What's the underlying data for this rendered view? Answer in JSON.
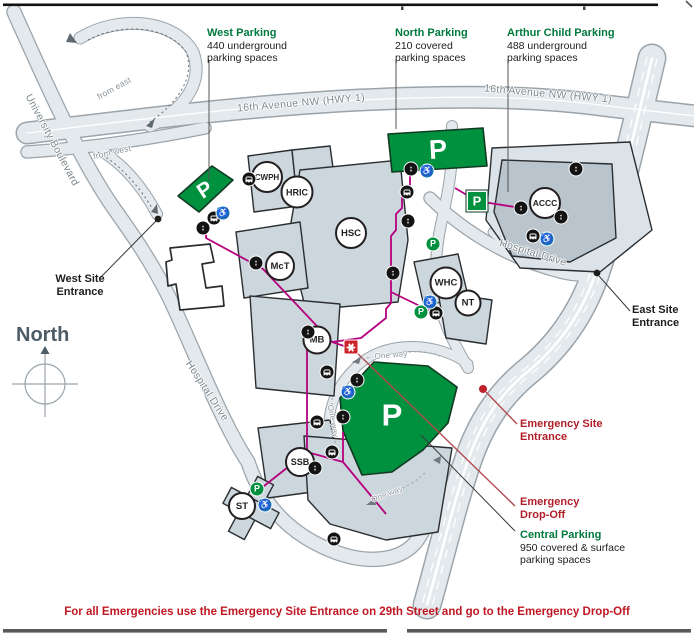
{
  "note": "For all Emergencies use the Emergency Site Entrance on 29th Street and go to the Emergency Drop-Off",
  "parking": {
    "west": {
      "title": "West Parking",
      "line1": "440 underground",
      "line2": "parking spaces"
    },
    "north": {
      "title": "North Parking",
      "line1": "210 covered",
      "line2": "parking spaces"
    },
    "arthur": {
      "title": "Arthur Child Parking",
      "line1": "488 underground",
      "line2": "parking spaces"
    },
    "central": {
      "title": "Central Parking",
      "line1": "950 covered & surface",
      "line2": "parking spaces"
    }
  },
  "entrances": {
    "west": {
      "line1": "West Site",
      "line2": "Entrance"
    },
    "east": {
      "line1": "East Site",
      "line2": "Entrance"
    },
    "emergency": {
      "line1": "Emergency Site",
      "line2": "Entrance"
    },
    "dropoff": {
      "line1": "Emergency",
      "line2": "Drop-Off"
    }
  },
  "roads": {
    "hwy_left": "16th Avenue NW (HWY 1)",
    "hwy_right": "16th Avenue NW (HWY 1)",
    "university": "University Boulevard",
    "hospital_left": "Hospital Drive",
    "hospital_right": "Hospital Drive",
    "from_east": "from east",
    "from_west": "from west",
    "one_way_top": "One way",
    "one_way_left": "One way",
    "one_way_bottom": "One way"
  },
  "compass": {
    "label": "North"
  },
  "buildings": [
    {
      "code": "CWPH"
    },
    {
      "code": "HRIC"
    },
    {
      "code": "HSC"
    },
    {
      "code": "McT"
    },
    {
      "code": "MB"
    },
    {
      "code": "SSB"
    },
    {
      "code": "ST"
    },
    {
      "code": "WHC"
    },
    {
      "code": "NT"
    },
    {
      "code": "ACCC"
    }
  ],
  "icons": {
    "parking_letter": "P",
    "elevator": "↕",
    "wheelchair": "♿"
  },
  "colors": {
    "parking_green": "#00913f",
    "parking_text_green": "#00793c",
    "emergency_red": "#b21e28",
    "walkway_magenta": "#b5007e",
    "road_fill": "#e3e9ec",
    "road_casing": "#9aa4ab",
    "accessible_blue": "#1b75bc"
  }
}
